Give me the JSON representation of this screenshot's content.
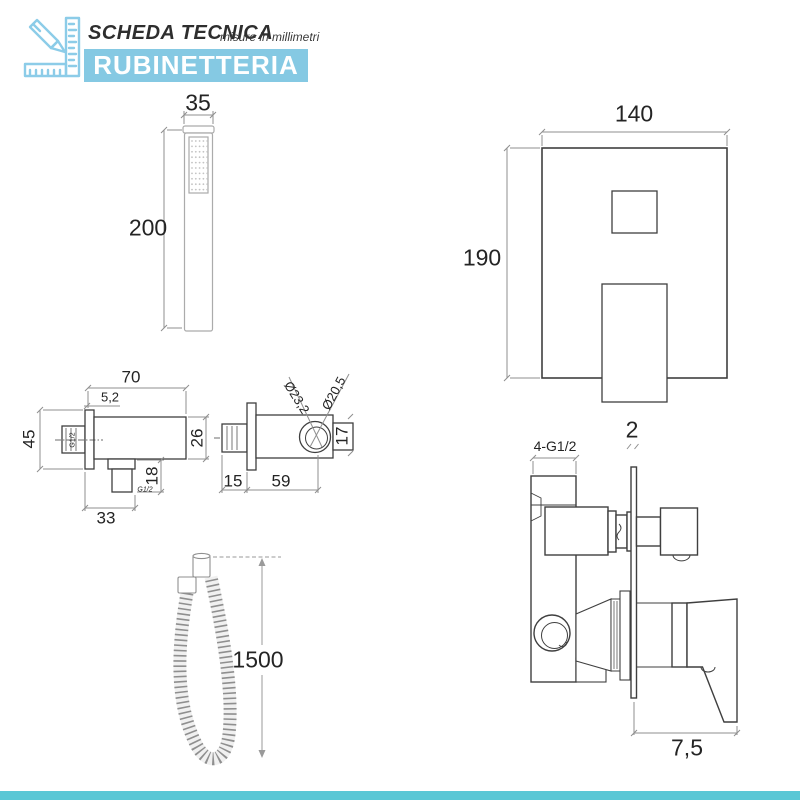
{
  "header": {
    "title": "SCHEDA TECNICA",
    "subtitle": "misure in millimetri",
    "category": "RUBINETTERIA"
  },
  "colors": {
    "accent_blue": "#85C9E3",
    "footer_strip": "#5AC7D5",
    "drawing_line": "#3f3f3f",
    "dimension_line": "#8f8f8f"
  },
  "components": {
    "hand_shower": {
      "width": "35",
      "height": "200"
    },
    "built_in_plate": {
      "width": "140",
      "height": "190"
    },
    "outlet_elbow": {
      "depth": "70",
      "plate_thickness": "5,2",
      "plate_height": "45",
      "body_height": "26",
      "outlet_height": "18",
      "bottom_width": "33",
      "thread_side": "G1/2",
      "thread_bottom": "G1/2"
    },
    "shower_holder": {
      "diameter_outer": "Ø23,2",
      "diameter_inner": "Ø20,5",
      "grip_width": "17",
      "flange_depth": "15",
      "body_length": "59"
    },
    "flexible_hose": {
      "length": "1500"
    },
    "mixer_body": {
      "plate_thickness": "2",
      "connections": "4-G1/2",
      "handle_depth": "7,5"
    }
  }
}
